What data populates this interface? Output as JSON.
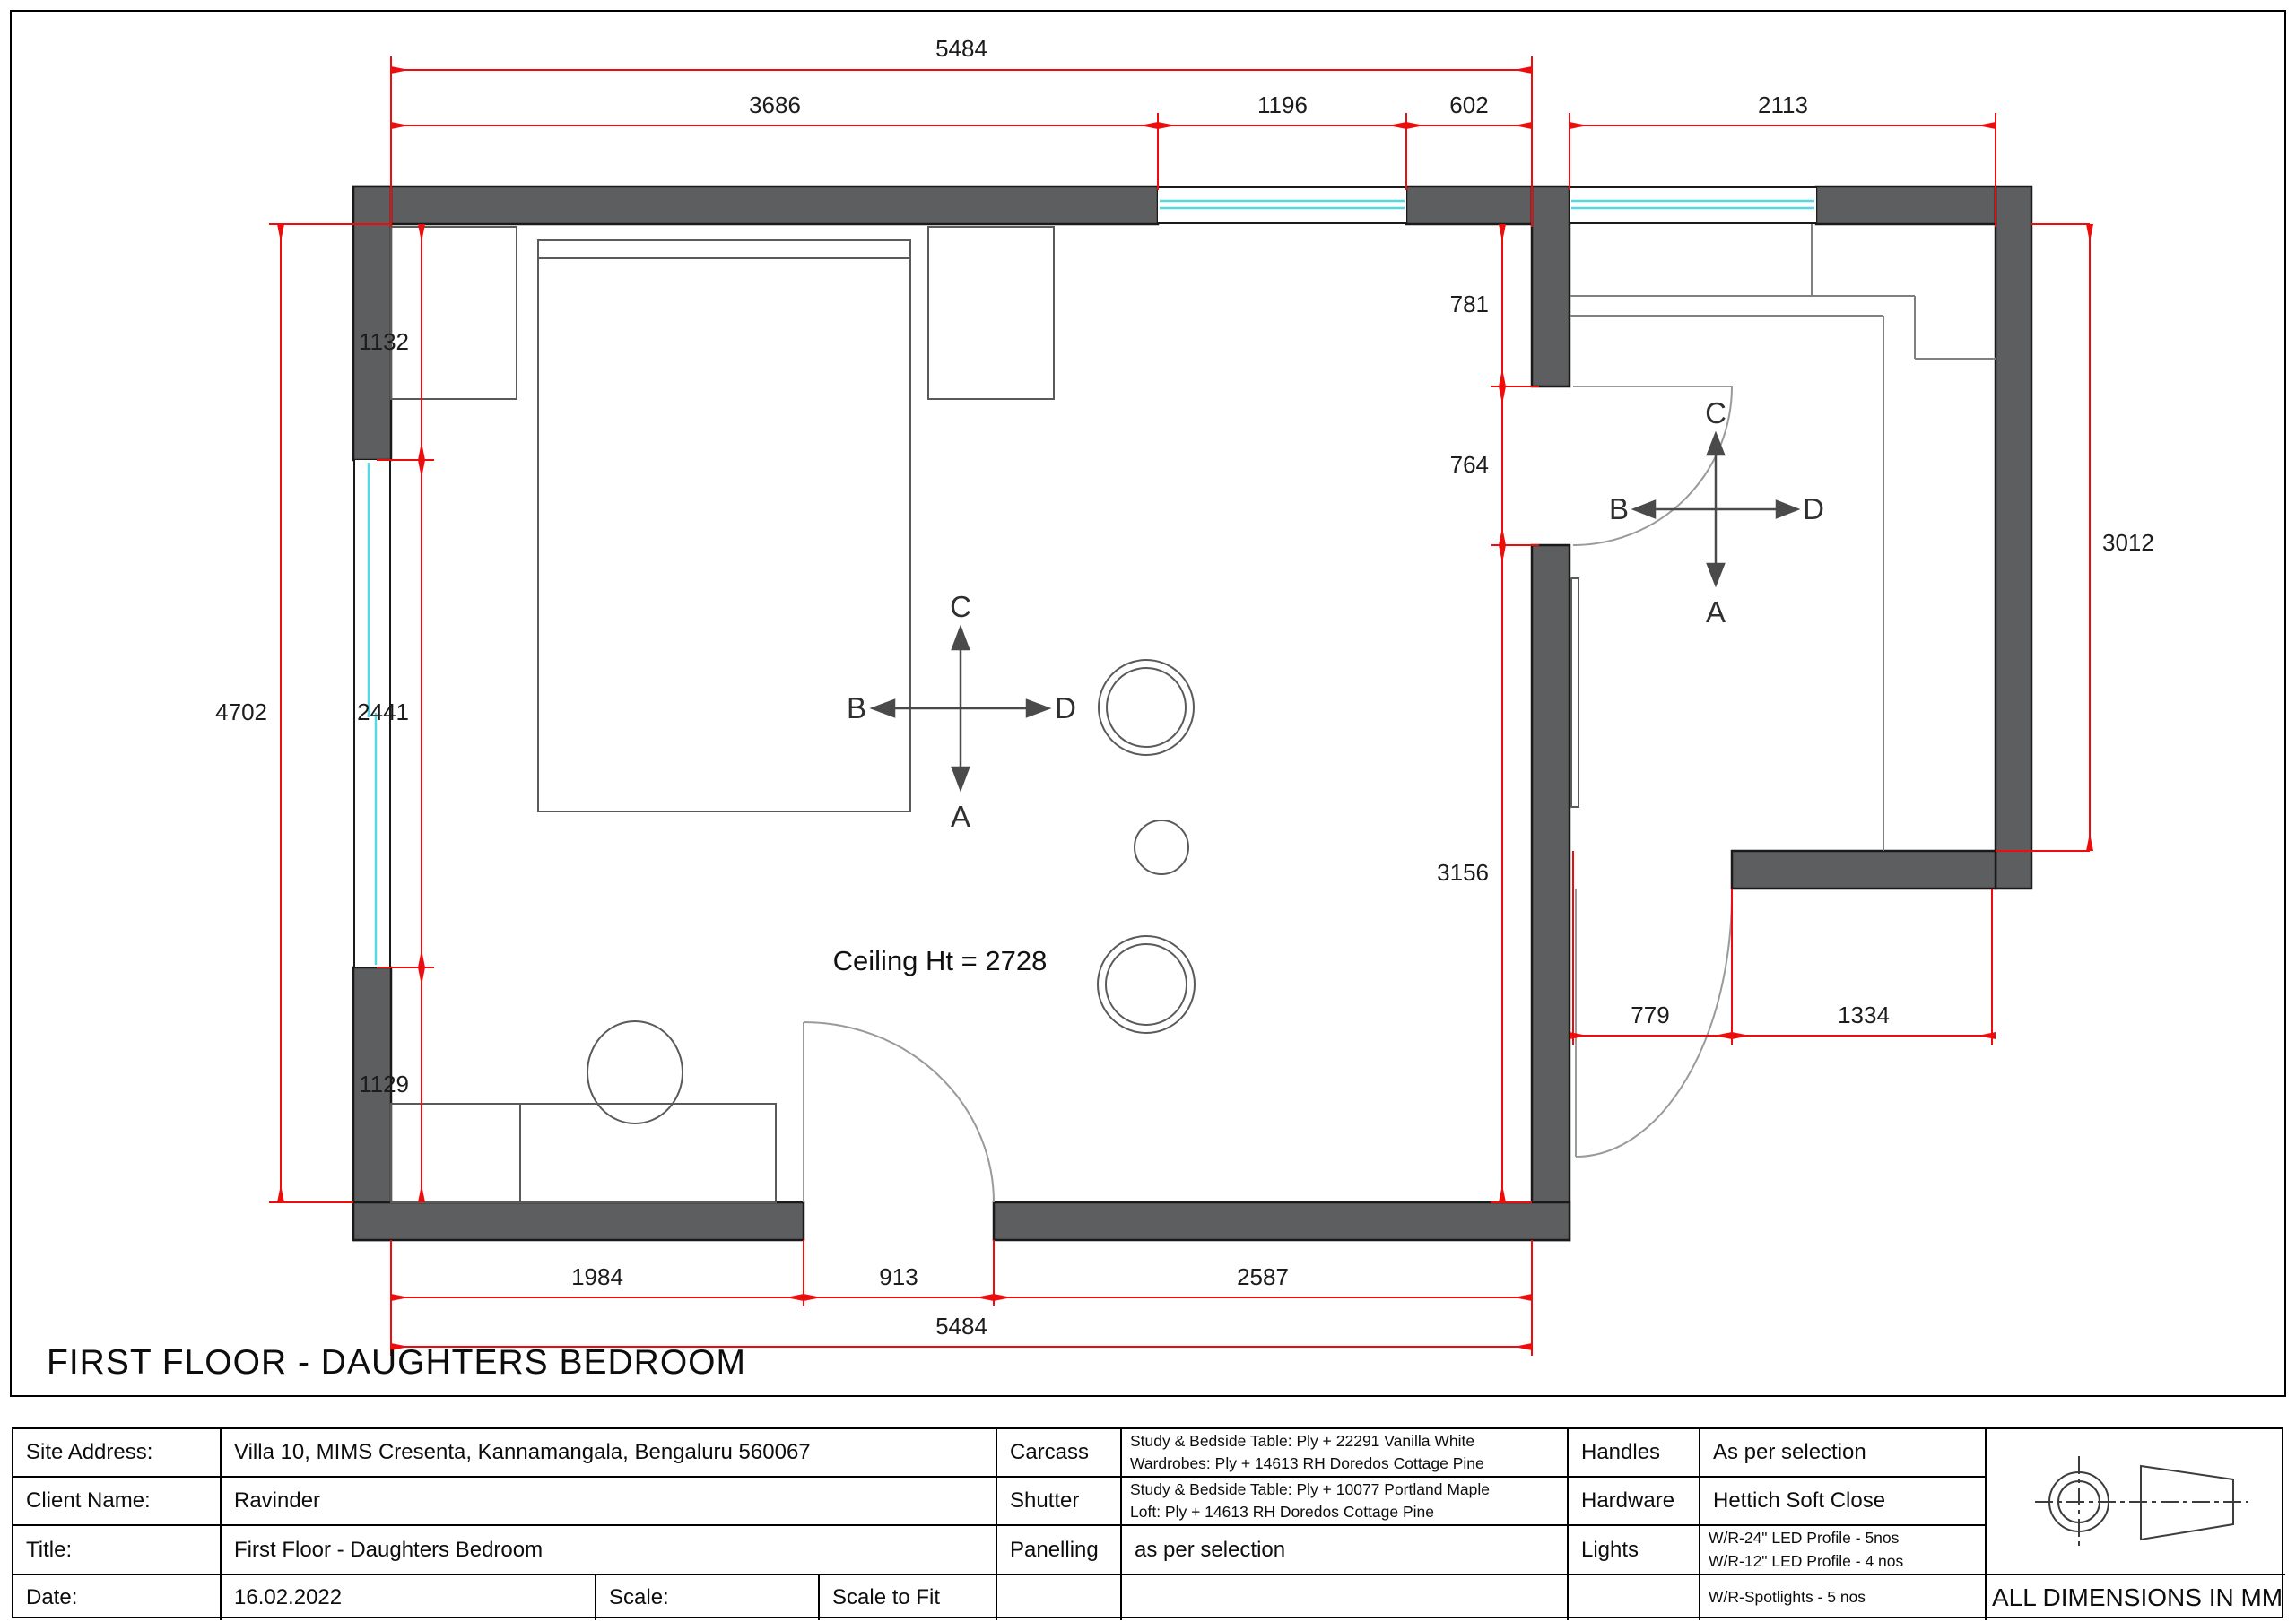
{
  "title": "FIRST FLOOR - DAUGHTERS BEDROOM",
  "plan": {
    "ceiling_note": "Ceiling Ht = 2728",
    "compass": {
      "up": "C",
      "down": "A",
      "left": "B",
      "right": "D"
    },
    "dims": {
      "top_total": "5484",
      "top_3686": "3686",
      "top_1196": "1196",
      "top_602": "602",
      "top_2113": "2113",
      "left_total": "4702",
      "left_1132": "1132",
      "left_2441": "2441",
      "left_1129": "1129",
      "mid_781": "781",
      "mid_764": "764",
      "mid_3156": "3156",
      "right_3012": "3012",
      "closet_779": "779",
      "closet_1334": "1334",
      "bottom_1984": "1984",
      "bottom_913": "913",
      "bottom_2587": "2587",
      "bottom_total": "5484"
    },
    "colors": {
      "wall_fill": "#5d5e60",
      "dimension_red": "#ee0d0d",
      "window_cyan": "#55d8e2",
      "line_black": "#1a1a1a"
    }
  },
  "title_block": {
    "site_address_label": "Site Address:",
    "site_address": "Villa 10, MIMS Cresenta, Kannamangala, Bengaluru 560067",
    "client_label": "Client Name:",
    "client": "Ravinder",
    "title_label": "Title:",
    "title_value": "First Floor - Daughters Bedroom",
    "date_label": "Date:",
    "date": "16.02.2022",
    "scale_label": "Scale:",
    "scale": "Scale to Fit",
    "carcass_label": "Carcass",
    "carcass_line1": "Study & Bedside Table: Ply + 22291 Vanilla White",
    "carcass_line2": "Wardrobes: Ply + 14613 RH Doredos Cottage Pine",
    "shutter_label": "Shutter",
    "shutter_line1": "Study & Bedside Table: Ply + 10077 Portland Maple",
    "shutter_line2": "Loft: Ply + 14613 RH Doredos Cottage Pine",
    "panelling_label": "Panelling",
    "panelling": "as per selection",
    "handles_label": "Handles",
    "handles": "As per selection",
    "hardware_label": "Hardware",
    "hardware": "Hettich Soft Close",
    "lights_label": "Lights",
    "lights_line1": "W/R-24\" LED Profile - 5nos",
    "lights_line2": "W/R-12\" LED Profile - 4 nos",
    "spotlights": "W/R-Spotlights - 5 nos",
    "all_dims_note": "ALL DIMENSIONS IN MM"
  }
}
